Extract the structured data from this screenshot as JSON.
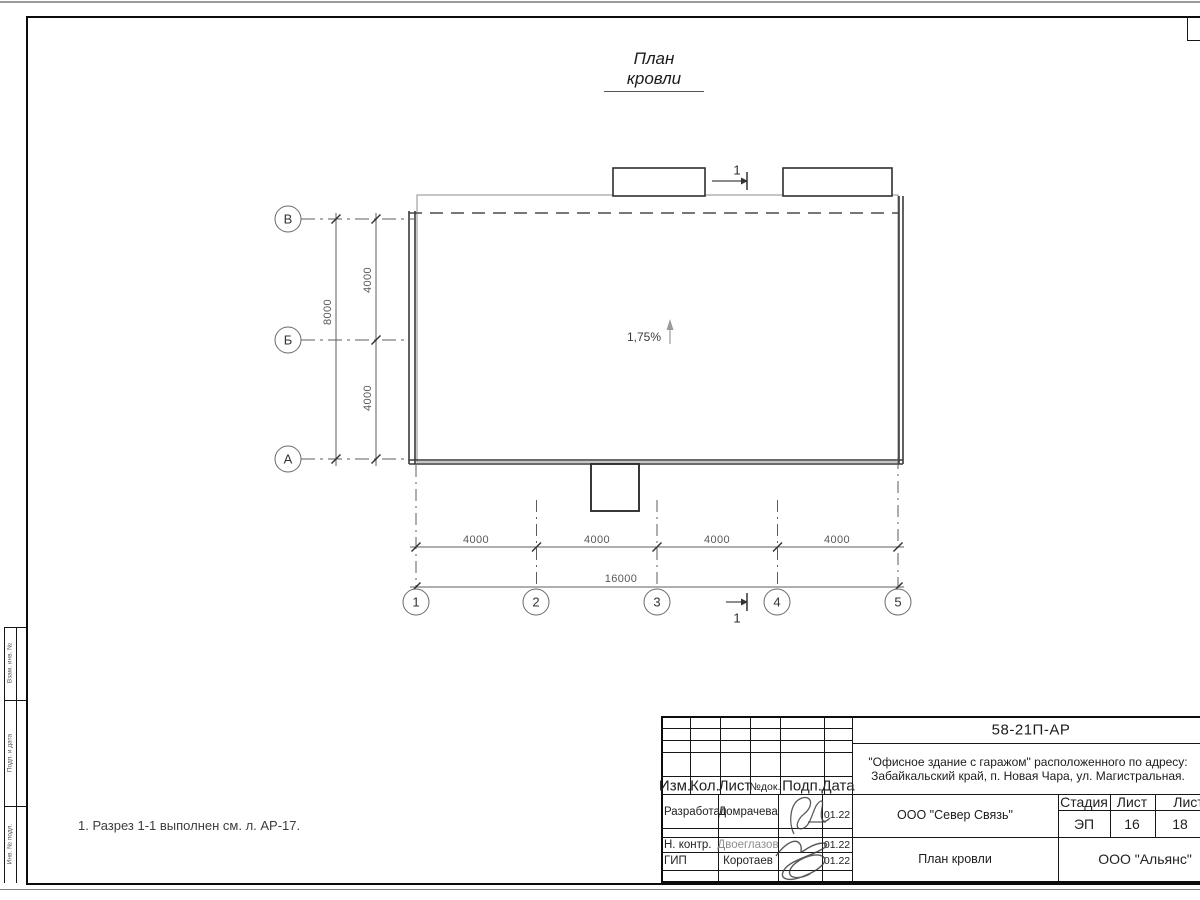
{
  "page": {
    "title": "План кровли",
    "note": "1. Разрез 1-1 выполнен см. л. АР-17."
  },
  "drawing": {
    "slope_label": "1,75%",
    "section_label": "1",
    "row_axes": [
      "В",
      "Б",
      "А"
    ],
    "col_axes": [
      "1",
      "2",
      "3",
      "4",
      "5"
    ],
    "v_total": "8000",
    "v_segments": [
      "4000",
      "4000"
    ],
    "h_total": "16000",
    "h_segments": [
      "4000",
      "4000",
      "4000",
      "4000"
    ]
  },
  "frame": {
    "side_cells": [
      "Взам. инв. №",
      "Подп. и дата",
      "Инв. № подл."
    ]
  },
  "titleblock": {
    "doc_number": "58-21П-АР",
    "project_line1": "\"Офисное здание с гаражом\" расположенного по адресу:",
    "project_line2": "Забайкальский край, п. Новая Чара, ул. Магистральная.",
    "header": {
      "izm": "Изм.",
      "kol": "Кол.",
      "list": "Лист",
      "ndok": "№док.",
      "podp": "Подп.",
      "data": "Дата"
    },
    "rows": [
      {
        "role": "Разработал",
        "name": "Домрачева",
        "date": "01.22"
      },
      {
        "role": "Н. контр.",
        "name": "Двоеглазов",
        "date": "01.22"
      },
      {
        "role": "ГИП",
        "name": "Коротаев",
        "date": "01.22"
      }
    ],
    "org": "ООО \"Север Связь\"",
    "sheet_title": "План кровли",
    "company": "ООО \"Альянс\"",
    "stage_header": {
      "stage": "Стадия",
      "sheet": "Лист",
      "sheets": "Листов"
    },
    "stage_values": {
      "stage": "ЭП",
      "sheet": "16",
      "sheets": "18"
    }
  }
}
